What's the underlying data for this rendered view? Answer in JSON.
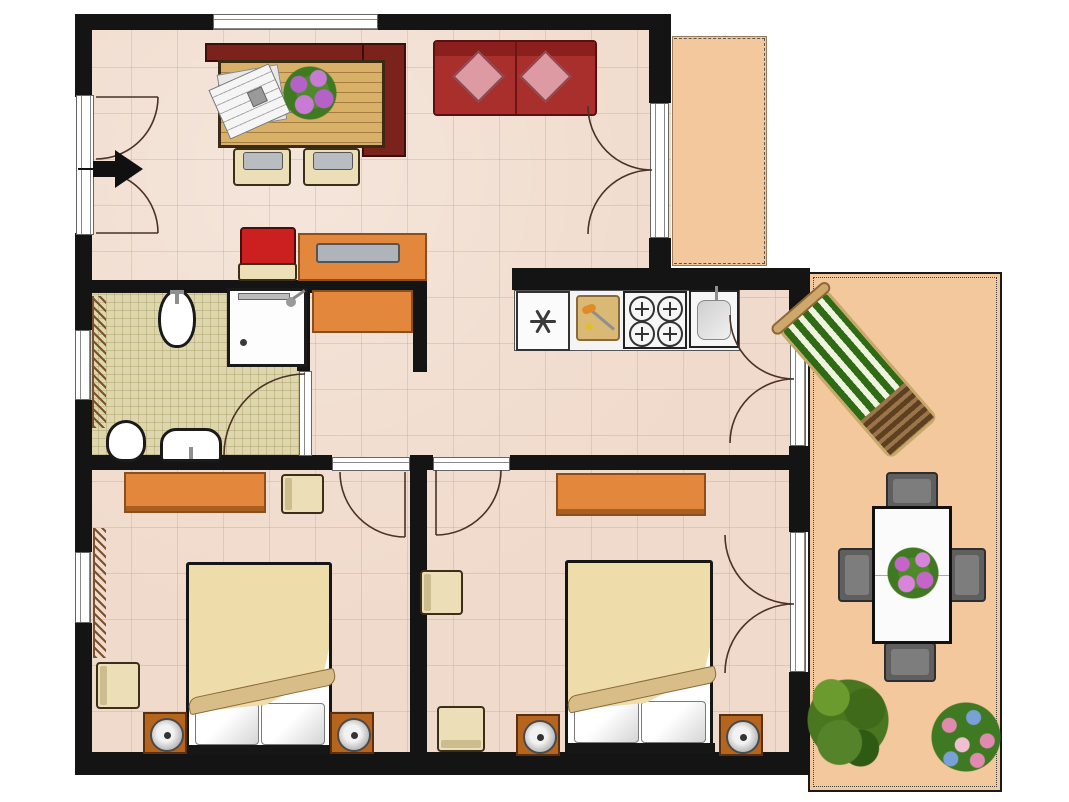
{
  "title": "apartment-floor-plan",
  "colors": {
    "wall": "#141414",
    "floor": "#f0dacb",
    "bathFloor": "#ded7ae",
    "outdoor": "#f3c89d",
    "orange": "#e2873b",
    "orangeDark": "#8a4f1d",
    "wood": "#d8b068",
    "maroon": "#7a221b",
    "sofaRed": "#a92f2d",
    "pillowPink": "#dd9aa2",
    "chairBeige": "#ecdfb8",
    "chairEdge": "#3c2f17",
    "bedCream": "#eedcab",
    "bedFold": "#d9bd88",
    "nightBrown": "#b5651d",
    "loungeGreen": "#2e6b14",
    "doorArc": "#4a3226"
  },
  "rooms": [
    {
      "name": "living-dining-room",
      "furniture": [
        "entrance-double-door",
        "entrance-direction-arrow",
        "top-window",
        "corner-bench",
        "wooden-dining-table",
        "newspapers",
        "flower-bouquet",
        "dining-chair-left",
        "dining-chair-right",
        "red-sofa",
        "sofa-pillow-left",
        "sofa-pillow-right",
        "desk",
        "desk-tray",
        "red-chair",
        "french-door-to-balcony"
      ]
    },
    {
      "name": "bathroom",
      "furniture": [
        "bidet",
        "shower-cabin",
        "toilet",
        "washbasin",
        "radiator",
        "window",
        "door"
      ]
    },
    {
      "name": "kitchen",
      "furniture": [
        "refrigerator",
        "cutting-board",
        "stove-four-burners",
        "kitchen-sink",
        "french-door-to-terrace"
      ]
    },
    {
      "name": "hallway",
      "furniture": [
        "sideboard-return",
        "bedroom-1-door",
        "bedroom-2-door"
      ]
    },
    {
      "name": "bedroom-1",
      "furniture": [
        "wardrobe",
        "chair-by-wardrobe",
        "double-bed",
        "pillows",
        "nightstand-with-lamp-left",
        "nightstand-with-lamp-right",
        "chair-by-window",
        "radiator",
        "window"
      ]
    },
    {
      "name": "bedroom-2",
      "furniture": [
        "wardrobe",
        "chair-by-wall",
        "chair-by-bottom-wall",
        "double-bed",
        "pillows",
        "nightstand-with-lamp-left",
        "nightstand-with-lamp-right",
        "french-door-to-terrace"
      ]
    },
    {
      "name": "balcony",
      "furniture": []
    },
    {
      "name": "terrace",
      "furniture": [
        "sun-lounger",
        "outdoor-dining-table",
        "flower-centerpiece",
        "outdoor-chair-north",
        "outdoor-chair-south",
        "outdoor-chair-west",
        "outdoor-chair-east",
        "green-plant",
        "flower-bush"
      ]
    }
  ]
}
